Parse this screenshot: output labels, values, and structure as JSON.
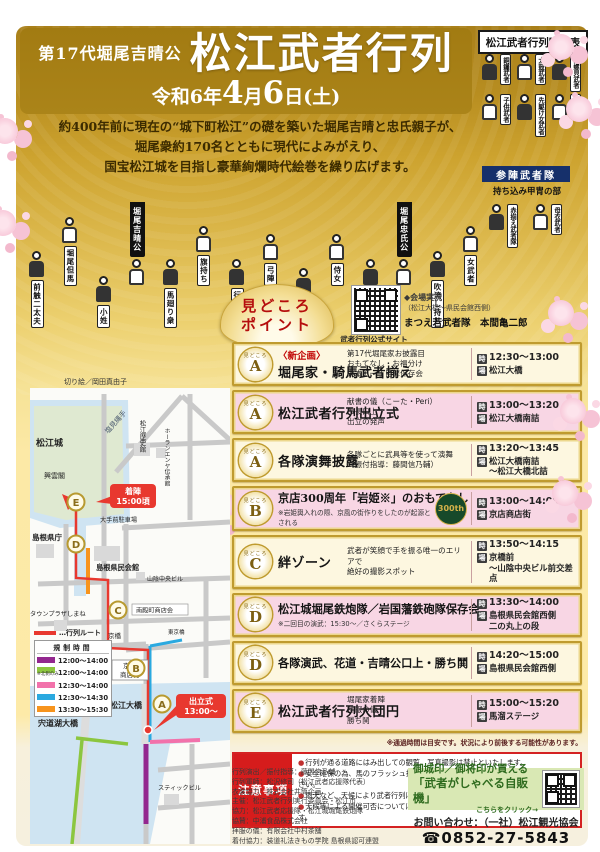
{
  "poster": {
    "header": {
      "era_title": "第17代堀尾吉晴公",
      "main_title": "松江武者行列",
      "date_era": "令和6年",
      "date_m": "4",
      "date_tsuki": "月",
      "date_d": "6",
      "date_nichi": "日",
      "date_dow": "(土)",
      "lineup_title": "松江武者行列隊列表"
    },
    "intro": "約400年前に現在の“城下町松江”の礎を築いた堀尾吉晴と忠氏親子が、\n堀尾衆約170名とともに現代によみがえり、\n国宝松江城を目指し豪華絢爛時代絵巻を繰り広げます。",
    "procession_figures": [
      {
        "label": "前触二太夫",
        "type": "fig"
      },
      {
        "label": "堀尾但馬",
        "type": "fig"
      },
      {
        "label": "小姓",
        "type": "fig"
      },
      {
        "label": "堀尾吉晴公",
        "type": "banner"
      },
      {
        "label": "馬廻り衆",
        "type": "fig"
      },
      {
        "label": "旗持ち",
        "type": "fig"
      },
      {
        "label": "行列軍師",
        "type": "fig"
      },
      {
        "label": "弓陣",
        "type": "fig"
      },
      {
        "label": "長松様",
        "type": "fig"
      },
      {
        "label": "侍女",
        "type": "fig"
      },
      {
        "label": "子供侍女",
        "type": "fig"
      },
      {
        "label": "堀尾忠氏公",
        "type": "banner"
      },
      {
        "label": "吹流し持ち",
        "type": "fig"
      },
      {
        "label": "女武者",
        "type": "fig"
      }
    ],
    "lineup_panel": {
      "figures": [
        "銅鑼武者",
        "太鼓武者",
        "法螺貝武者",
        "子供武者",
        "先駆け女武者",
        "槍武者"
      ],
      "sanjin_title": "参陣武者隊",
      "sanjin_subtitle": "持ち込み甲冑の部",
      "sanjin_figures": [
        "赤揃え武者隊",
        "母衣武者"
      ]
    },
    "artwork_credit": "切り絵／岡田真由子",
    "highlights": {
      "fan_line1": "見どころ",
      "fan_line2": "ポイント",
      "qr_caption": "武者行列公式サイト",
      "live_l1": "◆会場実況",
      "live_l2": "（松江大橋～県民会館西側）",
      "live_l3": "まつえ若武者隊　本間亀二郎",
      "badge_word": "見どころ",
      "time_label": "時",
      "place_label": "場",
      "rows": [
        {
          "badge": "A",
          "tag": "〈新企画〉",
          "title": "堀尾家・騎馬武者揃え",
          "details": "第17代堀尾家お披露目\nおもてなし・お福分け\n東本町一丁目鼕保存会",
          "time": "12:30～13:00",
          "place": "松江大橋",
          "bg": "cream"
        },
        {
          "badge": "A",
          "title": "松江武者行列出立式",
          "details": "献書の儀（こーた・Peri）\n市長口上\n出立の発声",
          "time": "13:00～13:20",
          "place": "松江大橋南詰",
          "bg": "pink"
        },
        {
          "badge": "A",
          "title": "各隊演舞披露",
          "details": "各隊ごとに武具等を使って演舞\n（振付指導：藤間信乃輔）",
          "time": "13:20～13:45",
          "place": "松江大橋南詰\n～松江大橋北詰",
          "bg": "cream"
        },
        {
          "badge": "B",
          "title": "京店300周年「岩姫※」のおもてなし",
          "note": "※岩姫輿入れの際、京風の街作りをしたのが起源とされる",
          "logo": "300th",
          "time": "13:00～14:00",
          "place": "京店商店街",
          "bg": "pink"
        },
        {
          "badge": "C",
          "title": "絆ゾーン",
          "details": "武者が笑顔で手を振る唯一のエリアで\n絶好の撮影スポット",
          "time": "13:50～14:15",
          "place": "京橋前\n～山陰中央ビル前交差点",
          "bg": "cream"
        },
        {
          "badge": "D",
          "title": "松江城堀尾鉄炮隊／岩国藩鉄砲隊保存会",
          "note": "※二回目の演武：15:30～／さくらステージ",
          "time": "13:30～14:00",
          "place": "島根県民会館西側\n二の丸上の段",
          "bg": "pink"
        },
        {
          "badge": "D",
          "title": "各隊演武、花道・吉晴公口上・勝ち鬨",
          "time": "14:20～15:00",
          "place": "島根県民会館西側",
          "bg": "cream"
        },
        {
          "badge": "E",
          "title": "松江武者行列大団円",
          "details": "堀尾家着陣\n拝服の儀\n勝ち鬨",
          "time": "15:00～15:20",
          "place": "馬溜ステージ",
          "bg": "pink"
        }
      ],
      "footnote": "※通過時間は目安です。状況により前後する可能性があります。"
    },
    "map": {
      "labels": {
        "shiomi_nawate": "塩見縄手",
        "matsue_castle": "松江城",
        "kounkaku": "興雲閣",
        "history_museum": "松江歴史館",
        "horan_enya": "ホーランエンヤ伝承館",
        "otemae_parking": "大手前駐車場",
        "pref_office": "島根県庁",
        "kenmin_hall": "島根県民会館",
        "sanin_bldg": "山陰中央ビル",
        "town_plaza": "タウンプラザしまね",
        "nandencho": "南殿町商店会",
        "kyobashi": "京橋",
        "higashi_kyobashi": "東京橋",
        "kyomise1": "京店",
        "kyomise2": "商店街",
        "matsue_ohashi": "松江大橋",
        "shinjiko_ohashi": "宍道湖大橋",
        "stick_bldg": "スティックビル"
      },
      "badges": {
        "a": "A",
        "b": "B",
        "c": "C",
        "d": "D",
        "e": "E"
      },
      "callouts": {
        "chakujin1": "着陣",
        "chakujin2": "15:00頃",
        "depart1": "出立式",
        "depart2": "13:00～"
      },
      "legend": {
        "route_label": "…行列ルート",
        "header": "規制時間",
        "rows": [
          {
            "color": "#93278f",
            "time": "12:00～14:00",
            "note": ""
          },
          {
            "color": "#8cc63f",
            "time": "12:00～14:00",
            "note": "※北側のみ"
          },
          {
            "color": "#f272ab",
            "time": "12:30～14:00",
            "note": ""
          },
          {
            "color": "#2aa9e0",
            "time": "12:30～14:30",
            "note": ""
          },
          {
            "color": "#f7941d",
            "time": "13:30～15:30",
            "note": ""
          }
        ]
      }
    },
    "notes": {
      "label": "注意事項",
      "items": [
        "行列が通る道路にはみ出しての観覧、写真撮影は禁止といたします。",
        "安全確保の為、馬のフラッシュ撮影、ドローン・脚立を使っての撮影はご遠慮ください。",
        "雨天など、天候により武者行列は中止となる可能性があります。",
        "天候等による開催可否については当日10：00にホームページにてお知らせいたします。"
      ]
    },
    "footer": {
      "credits": [
        "行列演出／振付指導：藤間信乃輔",
        "行列軍師：松沢修司（松江武者応援隊代表）",
        "衣裳協力：株式会社井筒企画",
        "主催：松江武者行列実行委員会・松江市",
        "協力：松江武者応援隊・松江城堀尾鉄炮隊",
        "協賛：中浦食品株式会社",
        "拝服の儀：有限会社中村茶舗",
        "着付協力：装道礼法きもの学院 島根県認可連盟"
      ],
      "promo_l1": "御城印／御将印が買える",
      "promo_l2": "「武者がしゃべる自販機」",
      "promo_l3": "こちらをクリック→",
      "contact": "お問い合わせ：（一社）松江観光協会",
      "phone": "☎0852-27-5843"
    }
  }
}
